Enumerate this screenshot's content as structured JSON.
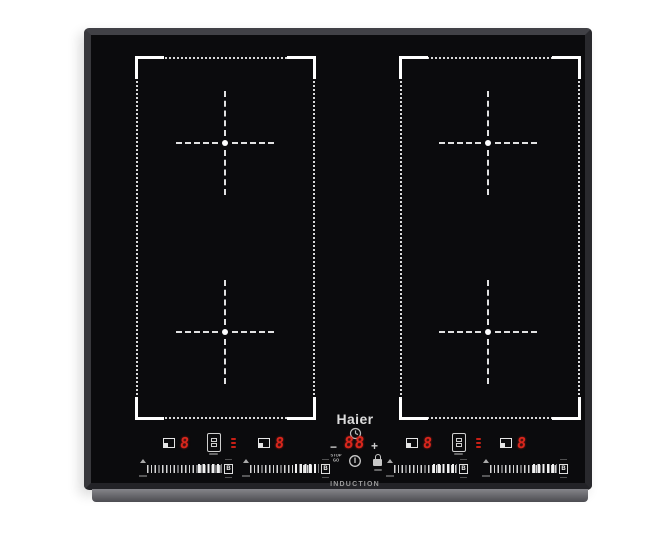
{
  "appliance": {
    "brand": "Haier",
    "product_label": "INDUCTION",
    "colors": {
      "glass": "#0b0b0d",
      "frame": "#38383c",
      "front_trim": "#77777b",
      "led_red": "#d8261c",
      "zone_marking": "#e8e8e8"
    }
  },
  "control_panel": {
    "zones": [
      {
        "name": "left-a",
        "power": "8",
        "boost": "B"
      },
      {
        "name": "left-b",
        "power": "8",
        "boost": "B"
      },
      {
        "name": "right-a",
        "power": "8",
        "boost": "B"
      },
      {
        "name": "right-b",
        "power": "8",
        "boost": "B"
      }
    ],
    "timer": {
      "minus": "−",
      "value": "88",
      "plus": "+"
    },
    "stop_go": {
      "line1": "STOP",
      "line2": "GO"
    },
    "brand_label": "Haier",
    "induction_label": "INDUCTION"
  }
}
